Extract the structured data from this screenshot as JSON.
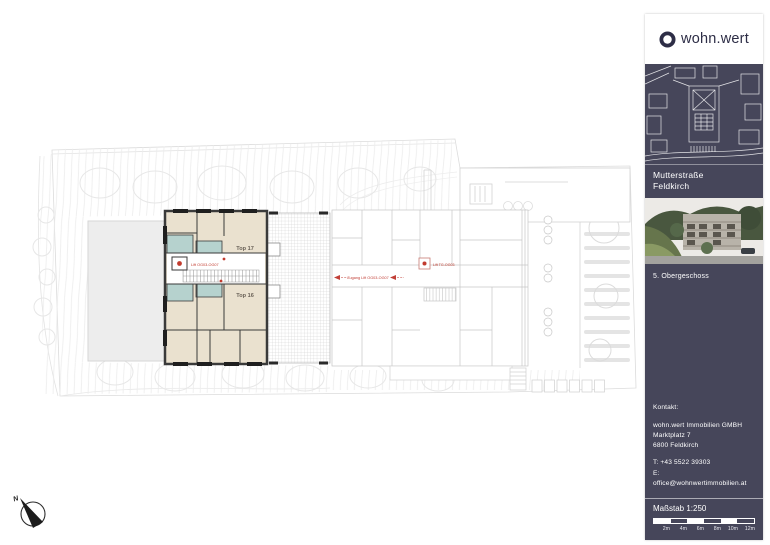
{
  "plan": {
    "apartments": {
      "top17": "Top 17",
      "top16": "Top 16"
    },
    "lift_left_label": "Lift OG03-OG07",
    "zugang_label": "Zugang Lift OG03-OG07",
    "lift_right_label": "Lift TG-OG03",
    "north_label": "N",
    "colors": {
      "room_beige": "#eae1cf",
      "room_teal": "#b6d2ce",
      "wall_dark": "#3a3a3a",
      "marker_red": "#c23b2e",
      "outline_grey": "#c6c6c6"
    }
  },
  "sidebar": {
    "logo_text": "wohn.wert",
    "project_title_line1": "Mutterstraße",
    "project_title_line2": "Feldkirch",
    "floor_label": "5. Obergeschoss",
    "contact": {
      "heading": "Kontakt:",
      "company": "wohn.wert Immobilien GMBH",
      "street": "Marktplatz 7",
      "city": "6800 Feldkirch",
      "phone": "T: +43 5522 39303",
      "email": "E: office@wohnwertimmobilien.at"
    },
    "scale": {
      "label": "Maßstab 1:250",
      "ticks": [
        "2m",
        "4m",
        "6m",
        "8m",
        "10m",
        "12m"
      ]
    },
    "colors": {
      "navy": "#46465a",
      "logo_navy": "#2d2d46"
    }
  }
}
